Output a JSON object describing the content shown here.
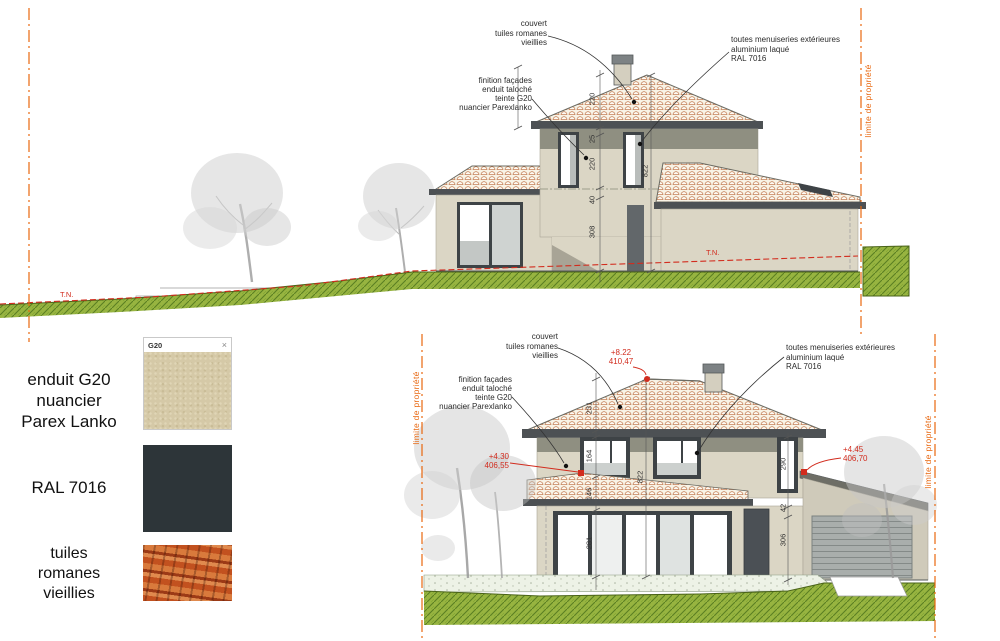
{
  "top_elevation": {
    "annotations": {
      "couvert": "couvert\ntuiles romanes\nvieillies",
      "menuiseries": "toutes menuiseries extérieures\naluminium laqué\nRAL 7016",
      "finition": "finition façades\nenduit taloché\nteinte G20\nnuancier Parexlanko",
      "tn_left": "T.N.",
      "tn_right": "T.N.",
      "limite_droite": "limite de propriété"
    },
    "dimensions": {
      "roof": "220",
      "eaves_band": "25",
      "window_level": "220",
      "slab": "40",
      "ground_level": "308",
      "total": "822"
    }
  },
  "bottom_elevation": {
    "annotations": {
      "couvert": "couvert\ntuiles romanes\nvieillies",
      "menuiseries": "toutes menuiseries extérieures\naluminium laqué\nRAL 7016",
      "finition": "finition façades\nenduit taloché\nteinte G20\nnuancier Parexlanko",
      "limite_gauche": "limite de propriété",
      "limite_droite": "limite de propriété"
    },
    "levels": {
      "ridge": "+8.22\n410,47",
      "left": "+4.30\n406,55",
      "right": "+4.45\n406,70"
    },
    "dimensions": {
      "roof": "231",
      "window_level": "164",
      "canopy": "146",
      "ground_level": "281",
      "total": "822",
      "right_window": "290",
      "spacer": "42",
      "door": "306"
    }
  },
  "materials": {
    "g20_card": {
      "title": "G20",
      "close": "×"
    },
    "g20_label": "enduit G20\nnuancier\nParex Lanko",
    "ral_label": "RAL 7016",
    "tuiles_label": "tuiles\nromanes\nvieillies"
  },
  "colors": {
    "property_line_orange": "#e8670f",
    "annotation_red": "#d22c1e",
    "wall_beige": "#dbd6c5",
    "roof_band_gray": "#4d5154",
    "grass_green": "#97b440",
    "ral7016": "#2d3539"
  }
}
